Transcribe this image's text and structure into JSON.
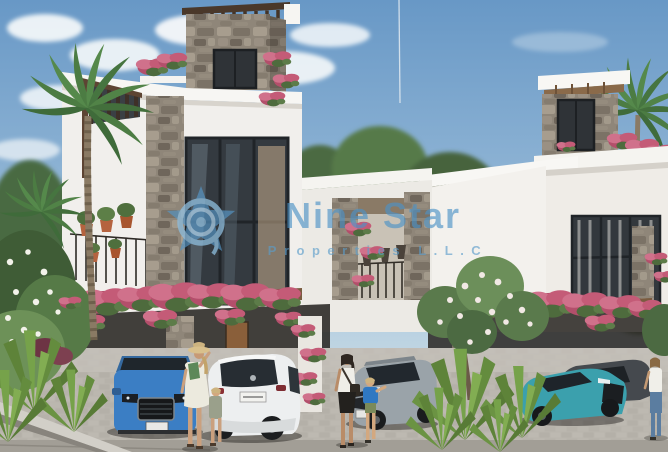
{
  "photo": {
    "kind": "real-estate architectural render",
    "subject": "modern two-storey townhouses with stone accents, rooftop pergolas, bougainvillea, carports with parked cars and pedestrians"
  },
  "watermark": {
    "line1": "Nine Star",
    "line2": "Properties L.L.C",
    "logo_icon": "nine-star-vortex-star-logo",
    "brand_blue": "#4d92c6"
  },
  "palette": {
    "sky_top": "#6898c6",
    "sky_horizon": "#d7e4ea",
    "wall_white": "#f3f1ed",
    "stone": "#8f8679",
    "bougainvillea_pink": "#c45b77",
    "foliage_green": "#55894b",
    "pavement": "#bab6ae",
    "car_blue": "#3b7ec4",
    "car_white": "#edeff0",
    "car_silver": "#9aa3a9",
    "car_teal": "#3ba0ad"
  }
}
